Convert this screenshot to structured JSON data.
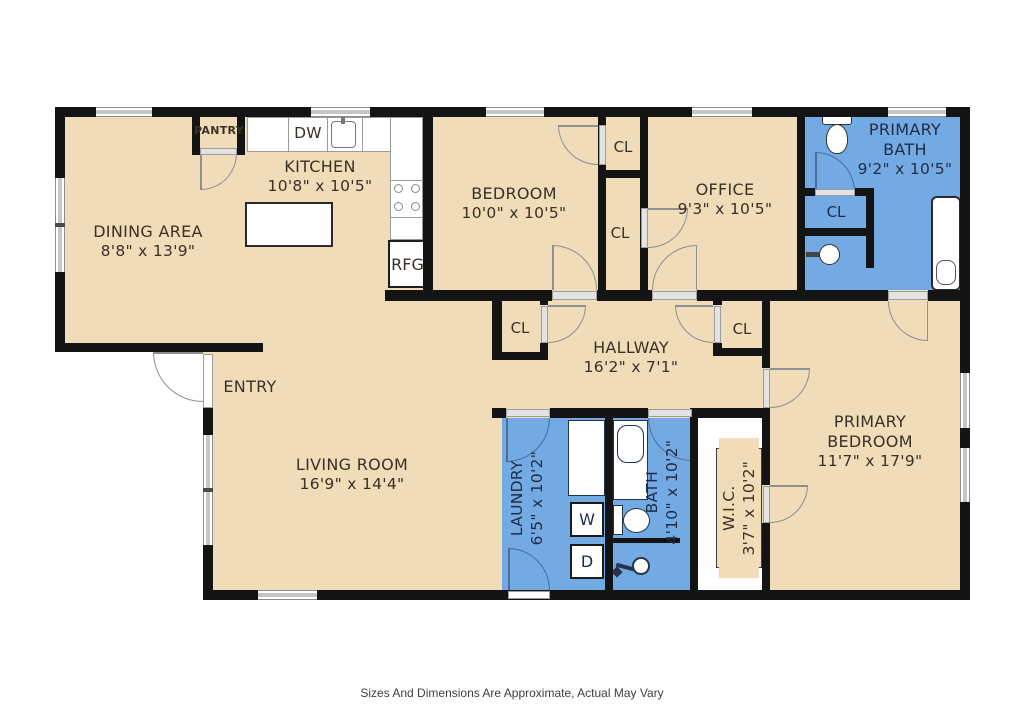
{
  "floorplan": {
    "footer_note": "Sizes And Dimensions Are Approximate, Actual May Vary",
    "colors": {
      "floor_tan": "#F1DCBA",
      "floor_blue": "#74AAE3",
      "wall": "#141414",
      "window_grey": "#C6C6C6",
      "door_arc_grey": "#8F8F8F",
      "door_arc_navy": "#4A6D9E",
      "label_dark": "#3A3123",
      "label_navy": "#1E2C45"
    },
    "rooms": {
      "dining": {
        "name": "DINING AREA",
        "dims": "8'8\" x 13'9\""
      },
      "kitchen": {
        "name": "KITCHEN",
        "dims": "10'8\" x 10'5\""
      },
      "bedroom": {
        "name": "BEDROOM",
        "dims": "10'0\" x 10'5\""
      },
      "office": {
        "name": "OFFICE",
        "dims": "9'3\" x 10'5\""
      },
      "primary_bath": {
        "name": "PRIMARY BATH",
        "dims": "9'2\" x 10'5\""
      },
      "hallway": {
        "name": "HALLWAY",
        "dims": "16'2\" x 7'1\""
      },
      "entry": {
        "name": "ENTRY"
      },
      "living_room": {
        "name": "LIVING ROOM",
        "dims": "16'9\" x 14'4\""
      },
      "laundry": {
        "name": "LAUNDRY",
        "dims": "6'5\" x 10'2\""
      },
      "bath": {
        "name": "BATH",
        "dims": "4'10\" x 10'2\""
      },
      "wic": {
        "name": "W.I.C.",
        "dims": "3'7\" x 10'2\""
      },
      "primary_bedroom": {
        "name": "PRIMARY BEDROOM",
        "dims": "11'7\" x 17'9\""
      }
    },
    "fixtures": {
      "pantry": "PANTRY",
      "closet": "CL",
      "dishwasher": "DW",
      "refrigerator": "RFG",
      "washer": "W",
      "dryer": "D"
    }
  }
}
